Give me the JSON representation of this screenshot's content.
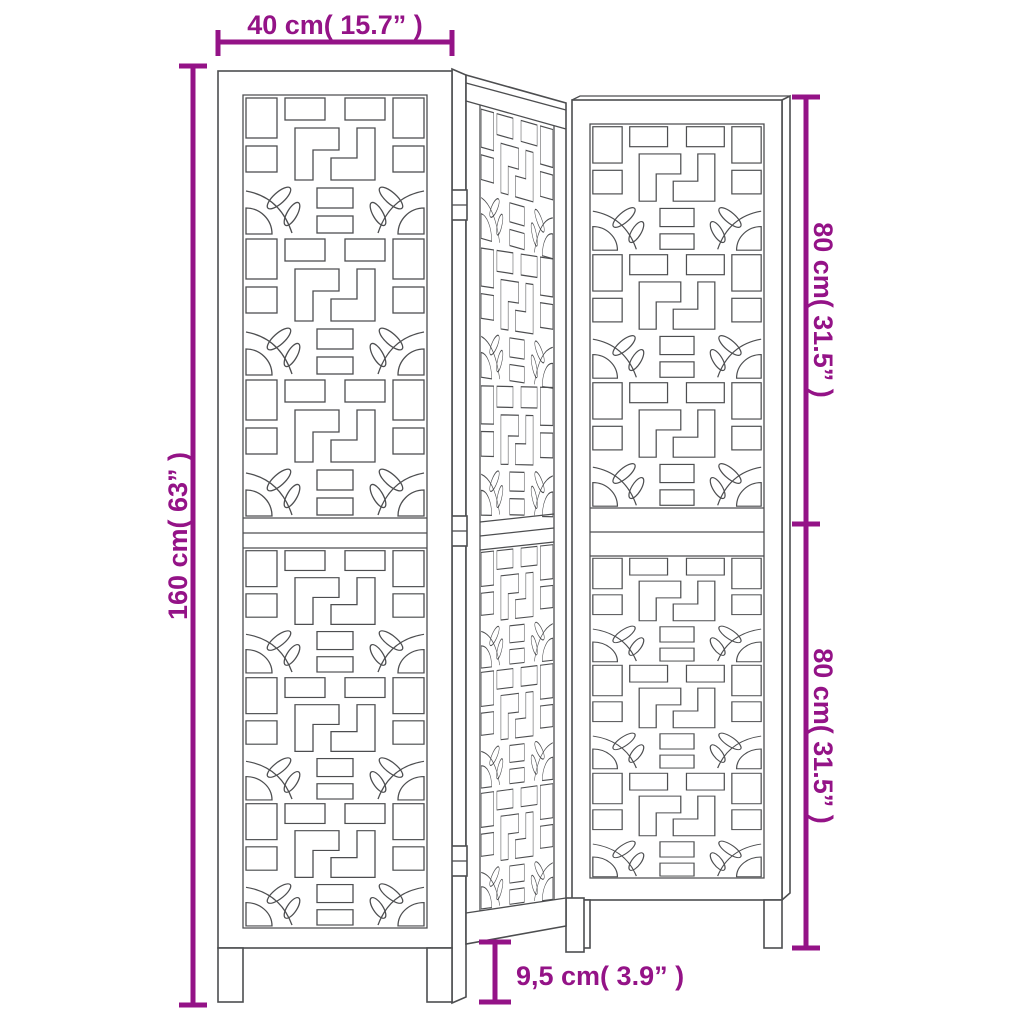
{
  "diagram": {
    "name": "room-divider-3-panel-dimension-diagram",
    "panel_count": 3
  },
  "dimensions": {
    "width": {
      "label": "40 cm( 15.7”  )"
    },
    "height": {
      "label": "160 cm( 63”  )"
    },
    "top_section": {
      "label": "80 cm( 31.5”  )"
    },
    "bottom_section": {
      "label": "80 cm( 31.5”  )"
    },
    "leg_height": {
      "label": "9,5 cm( 3.9”  )"
    }
  },
  "colors": {
    "dimension": "#941387",
    "line_art": "#4d4e50",
    "background": "#ffffff"
  }
}
